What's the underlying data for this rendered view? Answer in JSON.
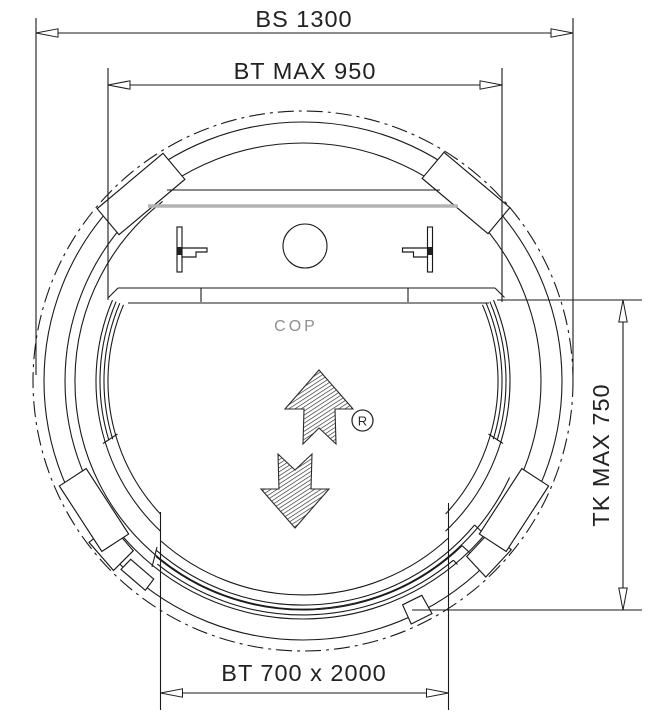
{
  "drawing": {
    "title": "round-homelift-shaft-plan",
    "dimensions": {
      "shaft_width": "BS 1300",
      "car_width": "BT MAX 950",
      "car_depth": "TK MAX 750",
      "door": "BT 700 x 2000"
    },
    "labels": {
      "cop": "COP",
      "registered": "R"
    },
    "colors": {
      "line": "#1a1a1a",
      "muted_text": "#8f8f8f",
      "gray_panel": "#b3b3b3"
    }
  }
}
